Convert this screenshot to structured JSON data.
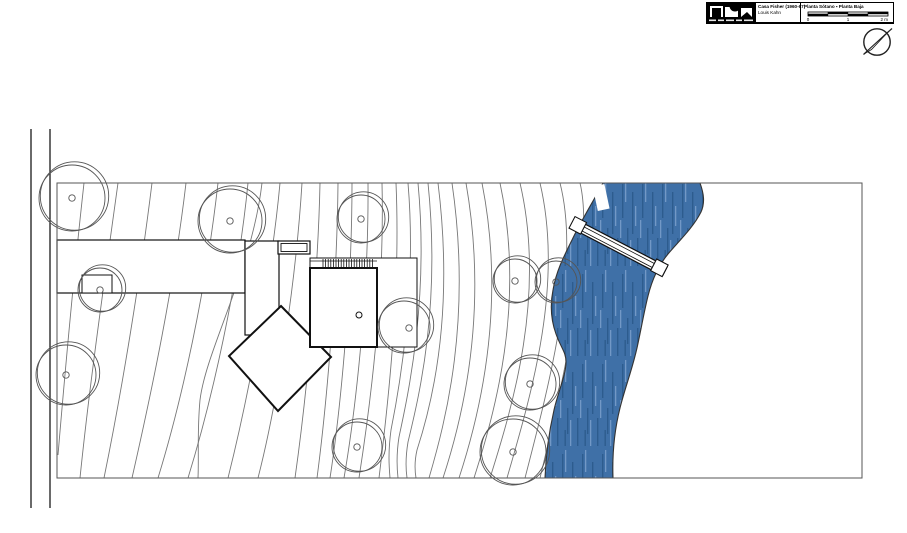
{
  "title_block": {
    "project": "Casa Fisher (1960-67)",
    "architect": "Louis Kahn",
    "sheet": "Planta Sótano ▪ Planta Baja",
    "scale_labels": [
      "0",
      "1",
      "2 m"
    ]
  },
  "colors": {
    "river": "#3f70a7",
    "river_dark": "#2d5c8e",
    "river_light": "#7298c6",
    "building_line": "#111111",
    "contour_line": "#777777",
    "tree_line": "#555555",
    "border_line": "#555555",
    "road_line": "#1a1a1a"
  },
  "site_plan": {
    "border": {
      "x": 57,
      "y": 183,
      "w": 805,
      "h": 295
    },
    "road_lines": [
      {
        "x": 31,
        "y1": 129,
        "y2": 508
      },
      {
        "x": 50,
        "y1": 129,
        "y2": 508
      }
    ],
    "contours": [
      "M 84,183 C 76,255 66,360 58,455",
      "M 118,183 C 106,270 90,380 80,478",
      "M 152,183 C 140,280 122,390 104,478",
      "M 186,183 C 174,285 152,390 132,478",
      "M 218,183 C 206,290 182,400 158,478",
      "M 248,183 C 238,285 212,400 188,478",
      "M 262,183 C 252,270 206,350 200,400 C 197,432 199,456 198,478",
      "M 280,183 C 272,270 250,390 228,478",
      "M 302,183 C 296,280 278,400 258,478",
      "M 320,183 C 318,280 306,400 295,478",
      "M 338,183 C 337,290 326,410 317,478",
      "M 352,183 C 352,300 339,420 330,478",
      "M 368,183 C 369,300 354,420 344,478",
      "M 382,183 C 385,300 368,420 359,478",
      "M 396,183 C 401,300 386,420 379,478",
      "M 408,183 C 417,290 399,390 391,430 C 388,452 389,466 390,478",
      "M 418,183 C 429,300 408,395 399,437 C 396,456 397,469 398,478",
      "M 428,183 C 441,310 418,400 408,442 C 405,460 406,471 407,478",
      "M 438,183 C 455,320 430,410 417,450 C 414,463 415,472 416,478",
      "M 452,183 C 472,320 446,420 429,478",
      "M 466,183 C 489,315 462,420 443,478",
      "M 482,183 C 507,310 478,420 459,478",
      "M 500,183 C 526,305 494,415 474,478",
      "M 520,183 C 546,295 513,405 490,478",
      "M 540,183 C 564,285 531,395 507,478",
      "M 560,183 C 581,265 549,385 525,478",
      "M 580,183 C 594,240 566,370 540,478"
    ],
    "river": {
      "fill_path": "M 603,183 C 594,200 581,221 572,240 C 563,258 556,272 553,290 C 550,305 551,320 556,334 C 561,348 566,352 566,362 C 566,375 558,392 554,410 C 549,432 546,452 545,478 L 613,478 C 612,450 615,428 620,408 C 625,388 632,370 637,348 C 641,330 644,312 648,296 C 652,280 658,266 668,254 C 678,242 693,228 701,212 C 705,203 704,194 700,183 Z",
      "bank_left": "M 603,183 C 594,200 581,221 572,240 C 563,258 556,272 553,290 C 550,305 551,320 556,334 C 561,348 566,352 566,362 C 566,375 558,392 554,410 C 549,432 546,452 545,478",
      "bank_right": "M 700,183 C 704,194 705,203 701,212 C 693,228 678,242 668,254 C 658,266 652,280 648,296 C 644,312 641,330 637,348 C 632,370 625,388 620,408 C 615,428 612,450 613,478"
    },
    "dock": {
      "x": 595,
      "y": 185,
      "w": 12,
      "h": 25,
      "angle": -12,
      "px": 601,
      "py": 197
    },
    "bridge": {
      "angle": 27.5,
      "px": 578,
      "py": 226,
      "body": {
        "x": 576,
        "y": 221,
        "w": 100,
        "h": 10
      },
      "inner_lines": [
        224,
        228.5
      ],
      "caps": [
        {
          "x": 571,
          "y": 219,
          "w": 13,
          "h": 13
        },
        {
          "x": 663,
          "y": 219,
          "w": 13,
          "h": 13
        }
      ]
    },
    "buildings": {
      "driveway_bar": {
        "x": 57,
        "y": 240,
        "w": 188,
        "h": 53
      },
      "notch": {
        "x": 82,
        "y": 275,
        "w": 30,
        "h": 18
      },
      "court": {
        "x": 245,
        "y": 241,
        "w": 34,
        "h": 94
      },
      "carport_outer": {
        "x": 278,
        "y": 241,
        "w": 32,
        "h": 13
      },
      "carport_inner": {
        "x": 281,
        "y": 243.5,
        "w": 26,
        "h": 8
      },
      "terrace": {
        "x": 310,
        "y": 258,
        "w": 107,
        "h": 89
      },
      "deck_hatch": {
        "x1": 323,
        "x2": 375,
        "y1": 259,
        "y2": 268,
        "step": 2.6,
        "top_line": 261,
        "bottom_line": 268.5,
        "edge1": 310,
        "edge2": 377
      },
      "diamond_points": "281,306 331,357 278,411 229,356",
      "main_square": {
        "x": 310,
        "y": 268,
        "w": 67,
        "h": 79
      },
      "door_dot": {
        "x": 359,
        "y": 315,
        "r": 3
      }
    },
    "trees": [
      {
        "x": 72,
        "y": 198,
        "r": 33
      },
      {
        "x": 230,
        "y": 221,
        "r": 32
      },
      {
        "x": 361,
        "y": 219,
        "r": 24
      },
      {
        "x": 100,
        "y": 290,
        "r": 22
      },
      {
        "x": 66,
        "y": 375,
        "r": 30
      },
      {
        "x": 404,
        "y": 327,
        "r": 26,
        "tdx": 5,
        "tdy": 1
      },
      {
        "x": 357,
        "y": 447,
        "r": 25
      },
      {
        "x": 515,
        "y": 281,
        "r": 22
      },
      {
        "x": 556,
        "y": 282,
        "r": 21
      },
      {
        "x": 530,
        "y": 384,
        "r": 26
      },
      {
        "x": 513,
        "y": 452,
        "r": 33
      }
    ]
  }
}
